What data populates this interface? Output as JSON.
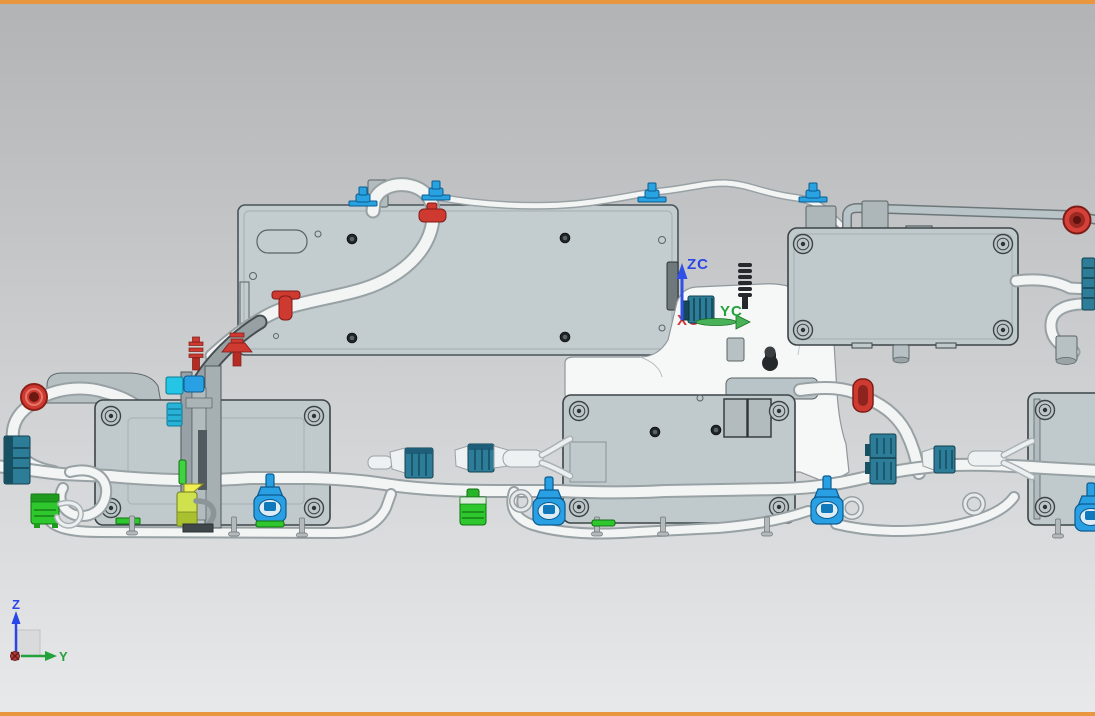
{
  "viewport": {
    "frame_color": "#e8973f",
    "background_top": "#b1b3b5",
    "background_bottom": "#e8e9ea"
  },
  "wcs_label": {
    "z": "ZC",
    "y": "YC",
    "x": "XC"
  },
  "triad_label": {
    "z": "Z",
    "y": "Y"
  },
  "axis_colors": {
    "z": "#2b46e6",
    "y": "#23a13c",
    "x": "#d23535"
  },
  "part_colors": {
    "panel_fill": "#c3cccf",
    "panel_edge": "#49545a",
    "tube_fill": "#f3f5f5",
    "tube_edge": "#98a1a4",
    "pipe_fill": "#b9c4c8",
    "clip_blue": "#29a2e2",
    "clamp_red": "#ce3a30",
    "connector_teal": "#2d7d99",
    "connector_green": "#2ec82e",
    "highlight_yellow": "#f2ee55",
    "stud_black": "#26292b"
  },
  "scene_parts": [
    "mounting-panel",
    "ecu-box-top-right",
    "ecu-box-center",
    "ecu-box-lower-left",
    "ecu-box-right",
    "harness-tubes",
    "coolant-pipe",
    "blue-tube-clips",
    "red-grommets",
    "red-tube-clamps",
    "teal-connectors",
    "green-connectors",
    "blue-tube-clamps",
    "fir-tree-stud",
    "bracket-column",
    "view-triad",
    "wcs-indicator"
  ]
}
